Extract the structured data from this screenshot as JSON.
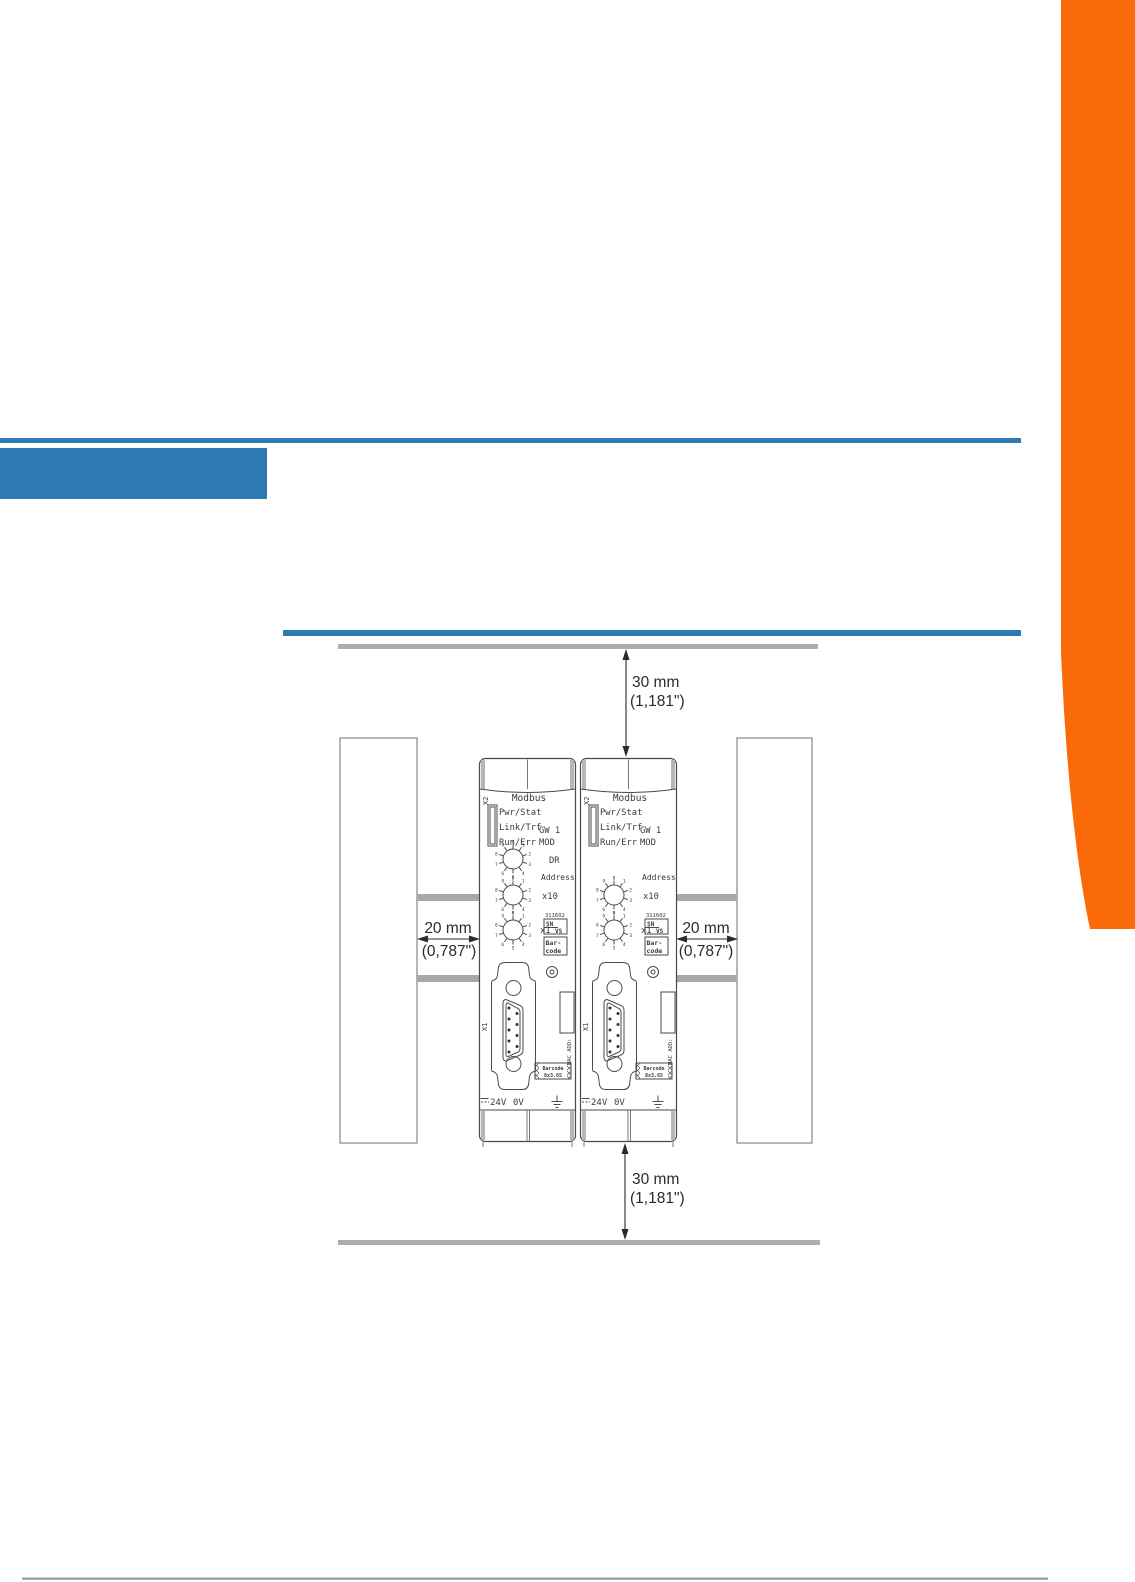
{
  "page": {
    "kind": "technical-manual-page",
    "background": "#ffffff"
  },
  "accent": {
    "orange": "#fb6a09",
    "blue": "#2e7ab5",
    "clearance_bar_gray": "#adadad",
    "din_rail_gray": "#a8a8a8",
    "footer_rule_gray": "#9a9a9a"
  },
  "diagram": {
    "clearance_vertical": {
      "mm": "30 mm",
      "inch": "(1,181\")"
    },
    "clearance_horizontal": {
      "mm": "20 mm",
      "inch": "(0,787\")"
    }
  },
  "device": {
    "port_top": "X2",
    "title": "Modbus",
    "leds": [
      "Pwr/Stat",
      "Link/Trf",
      "Run/Err"
    ],
    "type_line1": "GW 1",
    "type_line2": "MOD",
    "dr_label": "DR",
    "address_label": "Address",
    "x10_label": "x10",
    "x1_label": "x1",
    "article_number": "311602",
    "sn_label": "SN",
    "vs_label": "VS",
    "barcode_line1": "Bar-",
    "barcode_line2": "code",
    "rotary_digits": [
      "0",
      "1",
      "2",
      "3",
      "4",
      "5",
      "6",
      "7",
      "8",
      "9"
    ],
    "port_bottom": "X1",
    "mac_label": "MAC ADD:",
    "mini_barcode_line1": "Barcode",
    "mini_barcode_line2": "8x3.65",
    "power_24v": "24V",
    "power_0v": "0V"
  }
}
